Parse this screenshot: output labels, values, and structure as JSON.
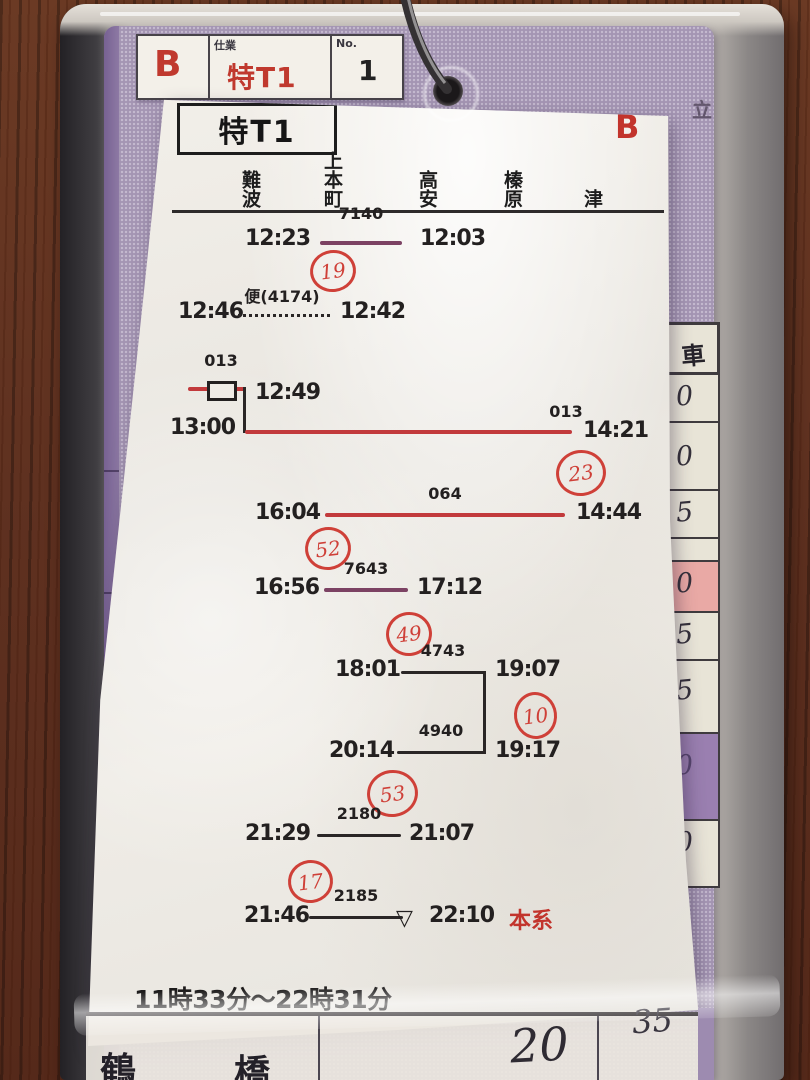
{
  "tag": {
    "corner_letter": "B",
    "duty_label": "仕業",
    "duty_value": "特T1",
    "no_label": "No.",
    "no_value": "1",
    "stamp": "立"
  },
  "paper": {
    "title": "特T1",
    "corner_letter": "B",
    "stations": [
      "難波",
      "上本町",
      "高安",
      "榛原",
      "津"
    ],
    "entries": [
      {
        "left_time": "12:23",
        "train_no": "7140",
        "right_time": "12:03",
        "line_style": "solid-purple",
        "circle_no": "19"
      },
      {
        "left_time": "12:46",
        "train_no": "便(4174)",
        "right_time": "12:42",
        "line_style": "dotted-black"
      },
      {
        "branch_train_no": "013",
        "branch_time": "12:49",
        "has_box_marker": true,
        "left_time": "13:00",
        "train_no": "013",
        "right_time": "14:21",
        "line_style": "solid-red",
        "circle_no": "23"
      },
      {
        "left_time": "16:04",
        "train_no": "064",
        "right_time": "14:44",
        "line_style": "solid-red",
        "circle_no": "52"
      },
      {
        "left_time": "16:56",
        "train_no": "7643",
        "right_time": "17:12",
        "line_style": "solid-purple",
        "circle_no": "49"
      },
      {
        "left_time": "18:01",
        "train_no": "4743",
        "right_time": "19:07",
        "line_style": "solid-black",
        "circle_no": "10"
      },
      {
        "left_time": "20:14",
        "train_no": "4940",
        "right_time": "19:17",
        "line_style": "solid-black",
        "circle_no": "53"
      },
      {
        "left_time": "21:29",
        "train_no": "2180",
        "right_time": "21:07",
        "line_style": "solid-black",
        "circle_no": "17"
      },
      {
        "left_time": "21:46",
        "train_no": "2185",
        "marker": "▽",
        "right_time": "22:10",
        "right_suffix": "本系",
        "line_style": "solid-black"
      }
    ],
    "footer": "11時33分〜22時31分"
  },
  "side_column": {
    "header": "車",
    "cells": [
      {
        "value": "0",
        "bg": "plain"
      },
      {
        "value": "0",
        "bg": "plain"
      },
      {
        "value": "5",
        "bg": "plain"
      },
      {
        "value": "",
        "bg": "plain"
      },
      {
        "value": "0",
        "bg": "pink"
      },
      {
        "value": "5",
        "bg": "plain"
      },
      {
        "value": "5",
        "bg": "plain"
      },
      {
        "value": "0",
        "bg": "purple"
      },
      {
        "value": "0",
        "bg": "plain"
      }
    ]
  },
  "bottom_row": {
    "station_chars": [
      "鶴",
      "橋"
    ],
    "value_left": "20",
    "value_right": "35"
  },
  "colors": {
    "card_purple": "#a495b3",
    "line_red": "#c23a3c",
    "line_purple": "#7c4263",
    "line_black": "#2a2626",
    "annotation_red": "#cf4038",
    "print_red": "#c2342c",
    "cell_pink": "#e9a9a5",
    "cell_purple": "#9a7fb0"
  }
}
